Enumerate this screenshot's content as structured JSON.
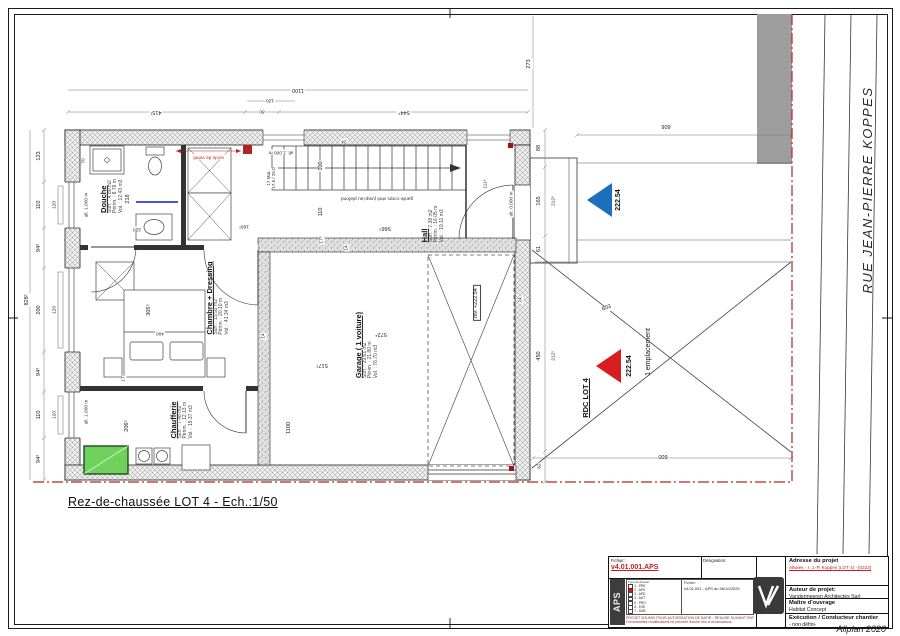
{
  "sheet": {
    "plan_title": "Rez-de-chaussée LOT 4 - Ech.:1/50",
    "street_name": "RUE JEAN-PIERRE KOPPES",
    "software": "Allplan 2020"
  },
  "colors": {
    "accent_red": "#c22121",
    "level_blue": "#1b6fbd",
    "level_red": "#d81f1f",
    "boundary_red": "#b32424",
    "equipment_green": "#6fd05c"
  },
  "rooms": {
    "douche": {
      "name": "Douche",
      "surface": "Surf. : 4.80 m2",
      "perimeter": "Périm. : 8.76 m",
      "volume": "Vol. : 12.43 m3"
    },
    "chambre": {
      "name": "Chambre + Dressing",
      "surface": "Surf. : 15.92 m2",
      "perimeter": "Périm. : 20.10 m",
      "volume": "Vol. : 41.34 m3"
    },
    "chaufferie": {
      "name": "Chaufferie",
      "surface": "Surf. : 7.48 m2",
      "perimeter": "Périm. : 12.13 m",
      "volume": "Vol. : 19.37 m3"
    },
    "hall": {
      "name": "Hall",
      "surface": "Surf. : 7.38 m2",
      "perimeter": "Périm. : 16.05 m",
      "volume": "Vol. : 19.11 m3"
    },
    "garage": {
      "name": "Garage ( 1 voiture)",
      "surface": "Surf. : 29.61 m2",
      "perimeter": "Périm. : 21.80 m",
      "volume": "Vol. : 76.70 m3"
    }
  },
  "levels": {
    "garage_level": "niv. +222.54",
    "entrance_level": "222.54",
    "parking_level": "222.54",
    "lot_label": "RDC LOT 4",
    "parking_label": "1 emplacement"
  },
  "annotations": {
    "guardrail": "garde-corps vitré jusqu'au plafond",
    "vent_base": "socle de ventil.",
    "stair_steps": "17 Mar.",
    "stair_ratio": "17.5 / 25.0",
    "alt_entrance": "alt. 0.000 m",
    "sill_a": "all. 1.000 m",
    "sill_b": "all. 1.000 m",
    "sill_c": "all. 1.000 m"
  },
  "dims": {
    "top_total": "1100",
    "top_seg1": "415¹",
    "top_seg2": "80",
    "top_seg3": "544⁴",
    "top_inner": "120",
    "top_right": "273",
    "left_total": "828²",
    "l1": "123",
    "l2": "110",
    "l3": "94³",
    "l4": "200",
    "l5": "94³",
    "l6": "110",
    "l7": "94³",
    "li1": "120",
    "li2": "120",
    "li3": "120",
    "r1": "88",
    "r2": "165",
    "r3": "61",
    "r4": "450",
    "r5": "62",
    "ri1": "212⁵",
    "ri2": "212¹",
    "site_top": "909",
    "site_bottom": "600",
    "site_diag": "603",
    "g1": "517⁵",
    "g2": "572⁴",
    "g3": "1100",
    "g4": "566⁵",
    "g5": "110",
    "g6": "100",
    "g7": "17⁵",
    "g8": "111⁵",
    "d1": "70",
    "d2": "218",
    "d3": "220",
    "d4": "166⁵",
    "c1": "305⁵",
    "c2": "400",
    "c3": "206⁵",
    "c4": "17",
    "w1": "24",
    "w2": "24",
    "w3": "14",
    "w4": "14"
  },
  "title_block": {
    "fichier_label": "Fichier:",
    "fichier_value": "v4.01.001.APS",
    "designation_label": "Désignation:",
    "aps_vertical": "APS",
    "dossier_header": "Type de dossier:",
    "dossier_types": [
      "1 - PRE",
      "2 - APS",
      "3 - APD",
      "4 - AUT",
      "5 - PRO",
      "6 - EXE",
      "7 - DAB"
    ],
    "fichier2_label": "Fichier:",
    "fichier2_value": "v4.01.001 - APS du 06/10/2025",
    "note_line1": "PROJET SOUMIS POUR AUTORISATION DE BATIR - REALISE SUIVANT PAP.",
    "note_line2": "D'éventuelles modifications ne peuvent donner lieu à réclamations.",
    "adresse_label": "Adresse du projet",
    "adresse_value": "Altwies - r. J.-P. Koppes (LOT 4) - [0222]",
    "auteur_label": "Auteur de projet:",
    "auteur_value": "Vandermeeren Architectes Sarl",
    "maitre_label": "Maître d'ouvrage",
    "maitre_value": "Habitat Concept",
    "exec_label": "Exécution / Conducteur chantier",
    "exec_value": "- non défini-"
  }
}
